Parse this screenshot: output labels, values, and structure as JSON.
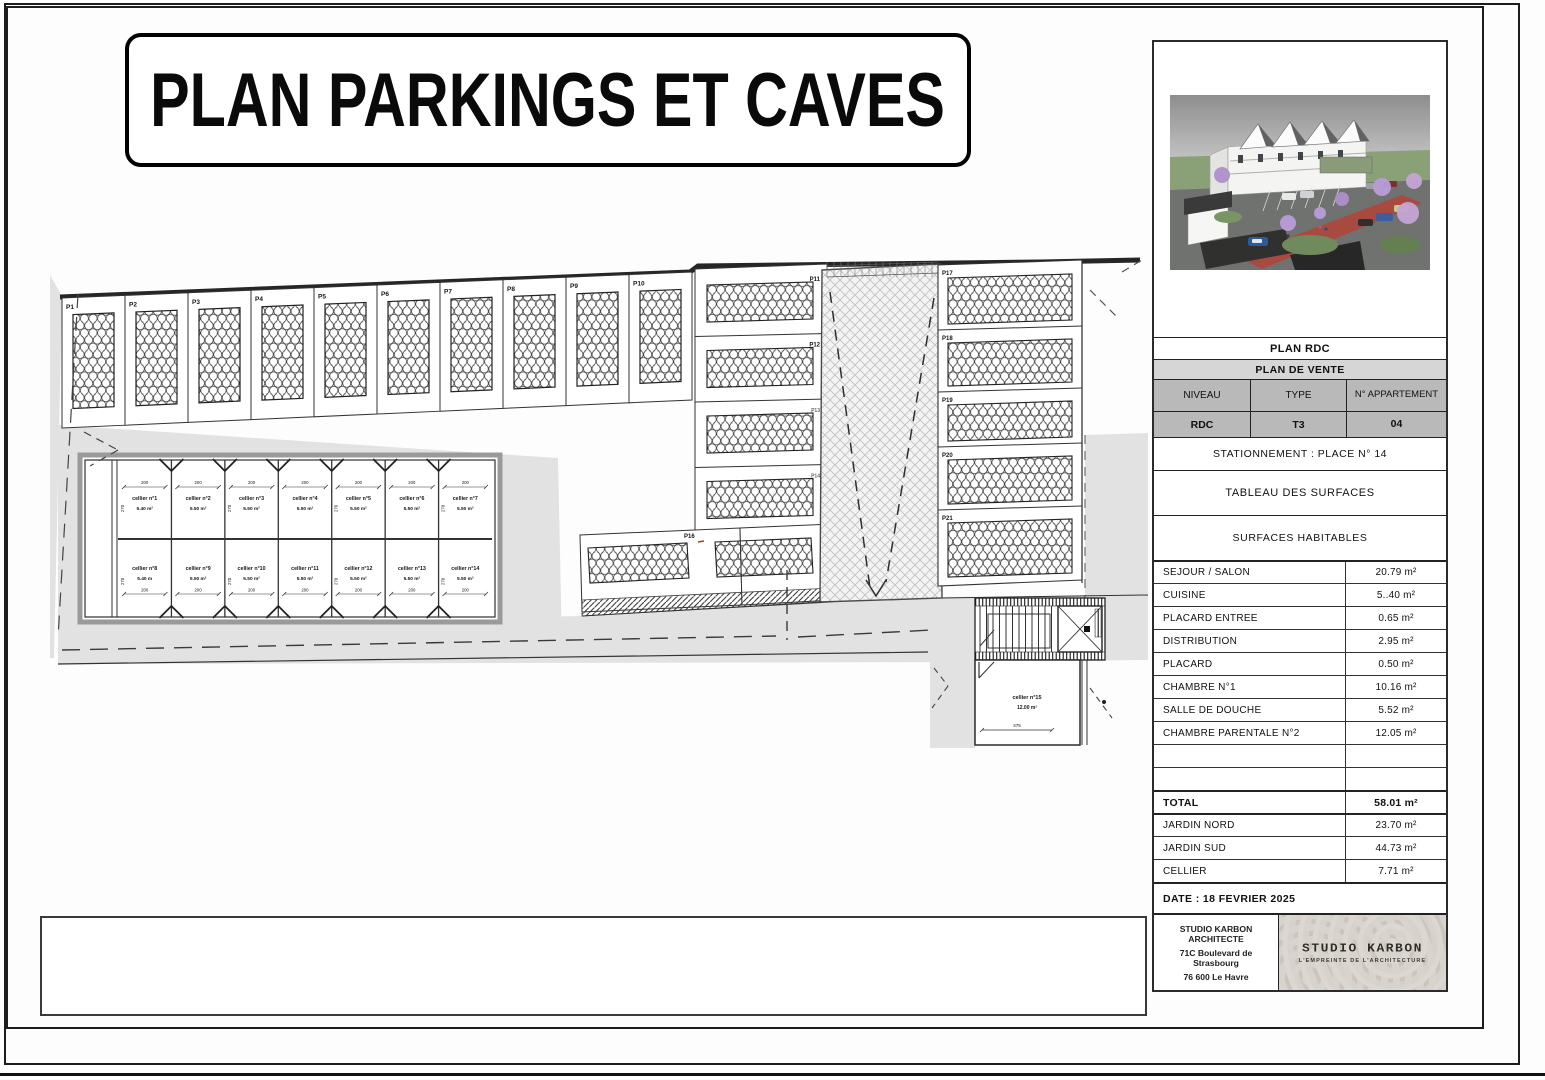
{
  "title": "PLAN PARKINGS ET CAVES",
  "plan": {
    "top_row_labels": [
      "P1",
      "P2",
      "P3",
      "P4",
      "P5",
      "P6",
      "P7",
      "P8",
      "P9",
      "P10"
    ],
    "middle_labels": [
      "P11",
      "P12",
      "P13",
      "P14"
    ],
    "pair_label": "P16",
    "right_labels": [
      "P17",
      "P18",
      "P19",
      "P20",
      "P21"
    ],
    "cellars_top": [
      {
        "name": "cellier n°1",
        "area": "5.40 m²"
      },
      {
        "name": "cellier n°2",
        "area": "5.50 m²"
      },
      {
        "name": "cellier n°3",
        "area": "5.50 m²"
      },
      {
        "name": "cellier n°4",
        "area": "5.50 m²"
      },
      {
        "name": "cellier n°5",
        "area": "5.50 m²"
      },
      {
        "name": "cellier n°6",
        "area": "5.50 m²"
      },
      {
        "name": "cellier n°7",
        "area": "5.50 m²"
      }
    ],
    "cellars_bottom": [
      {
        "name": "cellier n°8",
        "area": "5.40 m"
      },
      {
        "name": "cellier n°9",
        "area": "5.50 m²"
      },
      {
        "name": "cellier n°10",
        "area": "5.50 m²"
      },
      {
        "name": "cellier n°11",
        "area": "5.50 m²"
      },
      {
        "name": "cellier n°12",
        "area": "5.50 m²"
      },
      {
        "name": "cellier n°13",
        "area": "5.50 m²"
      },
      {
        "name": "cellier n°14",
        "area": "5.50 m²"
      }
    ],
    "cellar15": {
      "name": "cellier n°15",
      "area": "12.00 m²",
      "width_dim": "375"
    },
    "dim_horizontal": "200",
    "dim_vertical": "270"
  },
  "sidebar": {
    "plan_rdc": "PLAN RDC",
    "plan_de_vente": "PLAN DE VENTE",
    "headers": {
      "niveau": "NIVEAU",
      "type": "TYPE",
      "appartement": "N° APPARTEMENT"
    },
    "values": {
      "niveau": "RDC",
      "type": "T3",
      "appartement": "04"
    },
    "stationnement": "STATIONNEMENT : PLACE N° 14",
    "tableau": "TABLEAU DES SURFACES",
    "surfaces_habitables": "SURFACES HABITABLES",
    "surfaces": [
      {
        "label": "SEJOUR / SALON",
        "value": "20.79 m²"
      },
      {
        "label": "CUISINE",
        "value": "5..40 m²"
      },
      {
        "label": "PLACARD ENTREE",
        "value": "0.65 m²"
      },
      {
        "label": "DISTRIBUTION",
        "value": "2.95 m²"
      },
      {
        "label": "PLACARD",
        "value": "0.50 m²"
      },
      {
        "label": "CHAMBRE N°1",
        "value": "10.16 m²"
      },
      {
        "label": "SALLE DE DOUCHE",
        "value": "5.52 m²"
      },
      {
        "label": "CHAMBRE PARENTALE N°2",
        "value": "12.05 m²"
      },
      {
        "label": "",
        "value": ""
      },
      {
        "label": "",
        "value": ""
      }
    ],
    "total": {
      "label": "TOTAL",
      "value": "58.01 m²"
    },
    "annex": [
      {
        "label": "JARDIN NORD",
        "value": "23.70 m²"
      },
      {
        "label": "JARDIN SUD",
        "value": "44.73 m²"
      },
      {
        "label": "CELLIER",
        "value": "7.71 m²"
      }
    ],
    "date": "DATE : 18 FEVRIER 2025",
    "firm": [
      "STUDIO KARBON ARCHITECTE",
      "71C Boulevard de Strasbourg",
      "76 600 Le Havre"
    ],
    "logo": {
      "name": "STUDIO KARBON",
      "tagline": "L'EMPREINTE DE L'ARCHITECTURE"
    }
  },
  "disclaimer": {
    "lines": [
      "Les côtes et les surfaces sont mentionnées à titre indicatifs et sont susceptibles de variations dans les tolérances du contrat.",
      "Les gaines techniques, faux-plafonds, soffites connus sont mentionnés à titre indicatif.",
      "Pour de raisons techniques, administratives ou réglementaires, ils sont susceptibles d'être modifiés ou supprimés.",
      "Seuls les équipements définis dans la notice descriptive sont contractuels.",
      "La représentation graphique  des arbres et des haies est symbolique et n'a pas de caractère contractuel."
    ]
  }
}
